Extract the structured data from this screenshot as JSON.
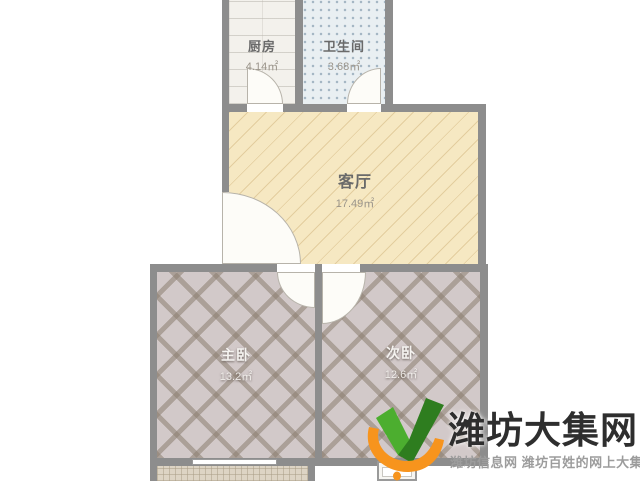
{
  "colors": {
    "wall": "#8d8d8d",
    "kitchen": "#f3f1ec",
    "bath": "#e9eff2",
    "living": "#f6e8c2",
    "bedroom": "#d2c9c9",
    "lattice": "rgba(139,126,112,0.55)",
    "balcony": "#ddd4c4",
    "doorfill": "#fdfcf8",
    "dooredge": "#b7b3aa",
    "labeldark": "#6a6a6a",
    "labellight": "#f5f3f0",
    "areadark": "#9a948a",
    "arealight": "rgba(246,244,241,0.9)",
    "green1": "#4cae2f",
    "green2": "#2e7d1f",
    "orange": "#f7941d",
    "titlecolor": "#2e2e2e",
    "subtitlecolor": "#9c9c9c"
  },
  "floorplan": {
    "rooms": [
      {
        "name": "厨房",
        "area": "4.14㎡"
      },
      {
        "name": "卫生间",
        "area": "3.68㎡"
      },
      {
        "name": "客厅",
        "area": "17.49㎡"
      },
      {
        "name": "主卧",
        "area": "13.2㎡"
      },
      {
        "name": "次卧",
        "area": "12.6㎡"
      }
    ]
  },
  "watermark": {
    "title": "潍坊大集网",
    "subtitle": "潍坊信息网 潍坊百姓的网上大集"
  }
}
